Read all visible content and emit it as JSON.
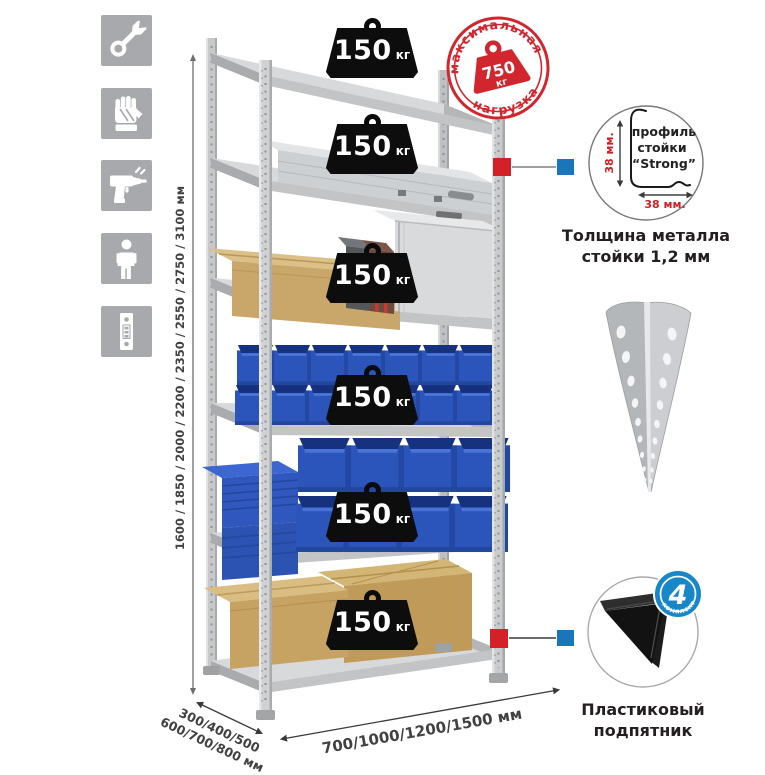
{
  "assembly_icons": {
    "items": [
      {
        "name": "wrench-icon"
      },
      {
        "name": "gloves-icon"
      },
      {
        "name": "drill-icon"
      },
      {
        "name": "person-icon"
      },
      {
        "name": "post-profile-icon"
      }
    ]
  },
  "dimensions": {
    "height_options": "1600 / 1850 / 2000 / 2200 / 2350 / 2550 / 2750 / 3100 мм",
    "depth_options_line1": "300/400/500",
    "depth_options_line2": "600/700/800 мм",
    "width_options": "700/1000/1200/1500 мм"
  },
  "max_load_stamp": {
    "arc_top": "максимальная",
    "arc_bottom": "нагрузка",
    "value": "750",
    "unit": "кг"
  },
  "shelf_loads": [
    {
      "value": "150",
      "unit": "кг"
    },
    {
      "value": "150",
      "unit": "кг"
    },
    {
      "value": "150",
      "unit": "кг"
    },
    {
      "value": "150",
      "unit": "кг"
    },
    {
      "value": "150",
      "unit": "кг"
    },
    {
      "value": "150",
      "unit": "кг"
    }
  ],
  "profile_detail": {
    "line1": "профиль",
    "line2": "стойки",
    "line3": "“Strong”",
    "height_dim": "38 мм.",
    "width_dim": "38 мм.",
    "caption_line1": "Толщина металла",
    "caption_line2": "стойки 1,2 мм"
  },
  "foot_detail": {
    "badge_count": "4",
    "badge_arc_text": "в комплекте",
    "caption": "Пластиковый подпятник"
  },
  "colors": {
    "stamp_red": "#d2262e",
    "marker_red": "#d42127",
    "marker_blue": "#1b75bb",
    "bin_blue": "#2b55bb",
    "icon_gray": "#a7a9ac"
  }
}
